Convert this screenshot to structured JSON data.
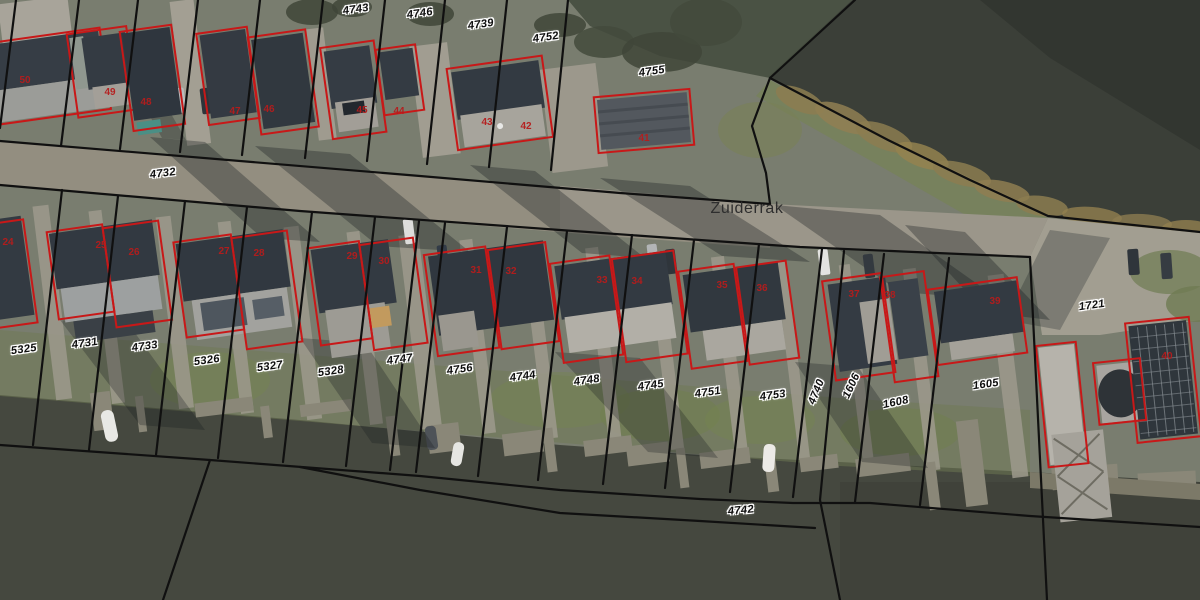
{
  "map": {
    "street_labels": [
      {
        "text": "Zuiderrak",
        "x": 747,
        "y": 209,
        "rot": 0
      }
    ],
    "parcel_labels": [
      {
        "text": "4743",
        "x": 356,
        "y": 10,
        "rot": -8
      },
      {
        "text": "4746",
        "x": 420,
        "y": 14,
        "rot": -8
      },
      {
        "text": "4739",
        "x": 481,
        "y": 25,
        "rot": -8
      },
      {
        "text": "4752",
        "x": 546,
        "y": 38,
        "rot": -8
      },
      {
        "text": "4755",
        "x": 652,
        "y": 72,
        "rot": -8
      },
      {
        "text": "4732",
        "x": 163,
        "y": 174,
        "rot": -7
      },
      {
        "text": "5325",
        "x": 24,
        "y": 350,
        "rot": -8
      },
      {
        "text": "4731",
        "x": 85,
        "y": 344,
        "rot": -8
      },
      {
        "text": "4733",
        "x": 145,
        "y": 347,
        "rot": -8
      },
      {
        "text": "5326",
        "x": 207,
        "y": 361,
        "rot": -8
      },
      {
        "text": "5327",
        "x": 270,
        "y": 367,
        "rot": -8
      },
      {
        "text": "5328",
        "x": 331,
        "y": 372,
        "rot": -8
      },
      {
        "text": "4747",
        "x": 400,
        "y": 360,
        "rot": -8
      },
      {
        "text": "4756",
        "x": 460,
        "y": 370,
        "rot": -8
      },
      {
        "text": "4744",
        "x": 523,
        "y": 377,
        "rot": -8
      },
      {
        "text": "4748",
        "x": 587,
        "y": 381,
        "rot": -8
      },
      {
        "text": "4745",
        "x": 651,
        "y": 386,
        "rot": -8
      },
      {
        "text": "4751",
        "x": 708,
        "y": 393,
        "rot": -8
      },
      {
        "text": "4753",
        "x": 773,
        "y": 396,
        "rot": -8
      },
      {
        "text": "4740",
        "x": 817,
        "y": 392,
        "rot": -68
      },
      {
        "text": "1606",
        "x": 852,
        "y": 386,
        "rot": -65
      },
      {
        "text": "1608",
        "x": 896,
        "y": 403,
        "rot": -12
      },
      {
        "text": "1605",
        "x": 986,
        "y": 385,
        "rot": -8
      },
      {
        "text": "1721",
        "x": 1092,
        "y": 306,
        "rot": -8
      },
      {
        "text": "4742",
        "x": 741,
        "y": 511,
        "rot": -5
      }
    ],
    "building_numbers": [
      {
        "text": "50",
        "x": 25,
        "y": 81
      },
      {
        "text": "49",
        "x": 110,
        "y": 93
      },
      {
        "text": "48",
        "x": 146,
        "y": 103
      },
      {
        "text": "47",
        "x": 235,
        "y": 112
      },
      {
        "text": "46",
        "x": 269,
        "y": 110
      },
      {
        "text": "45",
        "x": 362,
        "y": 111
      },
      {
        "text": "44",
        "x": 399,
        "y": 112
      },
      {
        "text": "43",
        "x": 487,
        "y": 123
      },
      {
        "text": "42",
        "x": 526,
        "y": 127
      },
      {
        "text": "41",
        "x": 644,
        "y": 139
      },
      {
        "text": "24",
        "x": 8,
        "y": 243
      },
      {
        "text": "25",
        "x": 101,
        "y": 246
      },
      {
        "text": "26",
        "x": 134,
        "y": 253
      },
      {
        "text": "27",
        "x": 224,
        "y": 252
      },
      {
        "text": "28",
        "x": 259,
        "y": 254
      },
      {
        "text": "29",
        "x": 352,
        "y": 257
      },
      {
        "text": "30",
        "x": 384,
        "y": 262
      },
      {
        "text": "31",
        "x": 476,
        "y": 271
      },
      {
        "text": "32",
        "x": 511,
        "y": 272
      },
      {
        "text": "33",
        "x": 602,
        "y": 281
      },
      {
        "text": "34",
        "x": 637,
        "y": 282
      },
      {
        "text": "35",
        "x": 722,
        "y": 286
      },
      {
        "text": "36",
        "x": 762,
        "y": 289
      },
      {
        "text": "37",
        "x": 854,
        "y": 295
      },
      {
        "text": "38",
        "x": 890,
        "y": 296
      },
      {
        "text": "39",
        "x": 995,
        "y": 302
      },
      {
        "text": "40",
        "x": 1167,
        "y": 357
      }
    ],
    "colors": {
      "parcel_line": "#101010",
      "building_outline": "#c81818",
      "parcel_label_text": "#0d0d0d",
      "parcel_label_halo": "#ffffff",
      "building_number_text": "#b61c1c",
      "street_label_text": "#2e2e2e"
    }
  }
}
